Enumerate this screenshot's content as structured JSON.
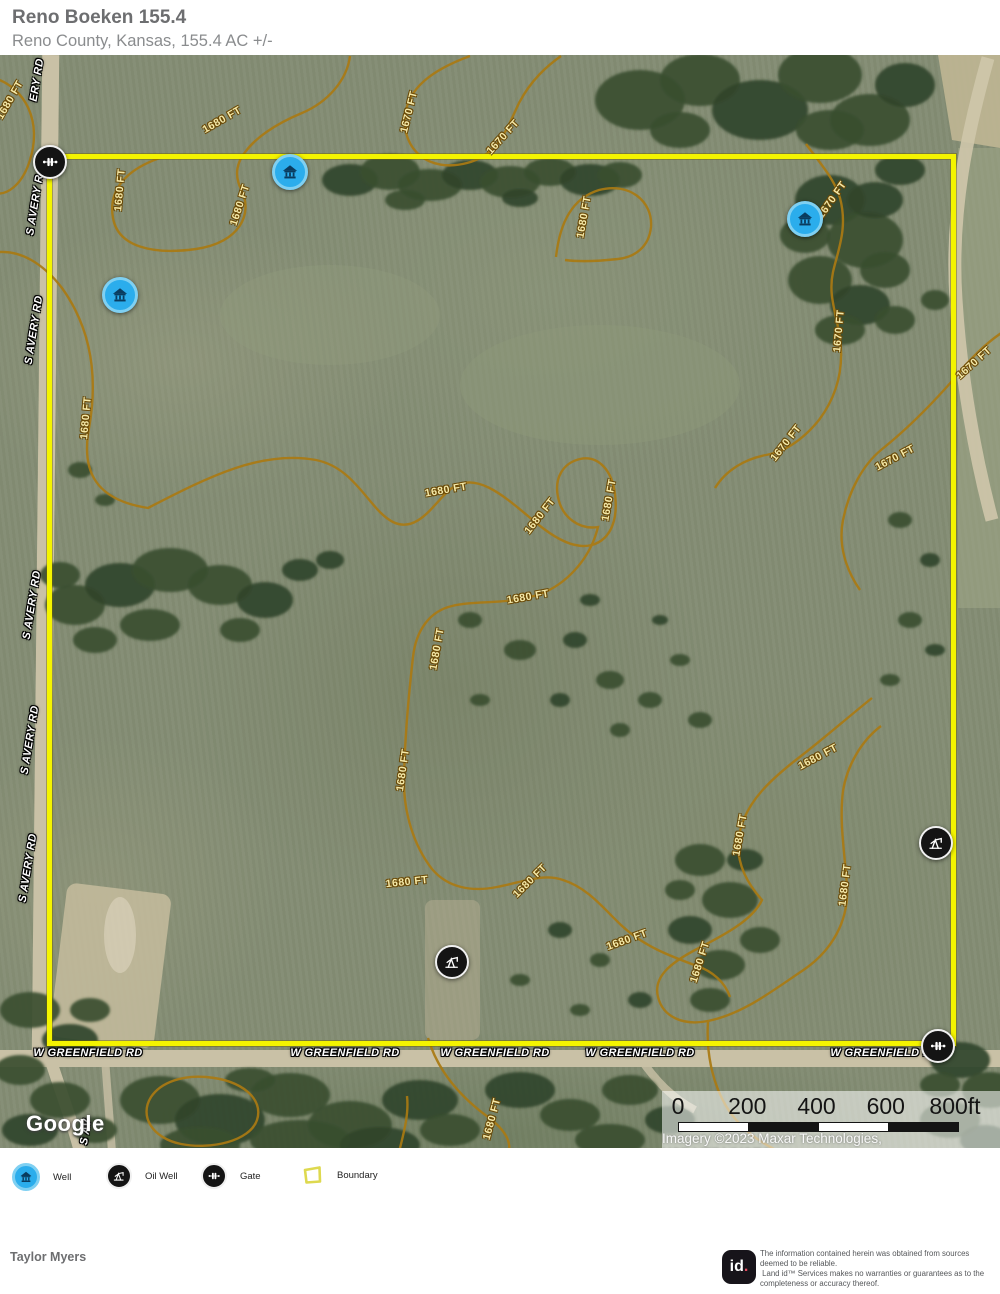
{
  "header": {
    "title": "Reno Boeken 155.4",
    "subtitle": "Reno County, Kansas, 155.4 AC +/-"
  },
  "map": {
    "google_logo": "Google",
    "attribution": "Imagery ©2023 Maxar Technologies, USDA/FPAC/GEO",
    "scale_bar": {
      "ticks": [
        "0",
        "200",
        "400",
        "600",
        "800ft"
      ]
    },
    "road_labels": [
      {
        "text": "W GREENFIELD RD",
        "x": 88,
        "y": 998,
        "r": 0
      },
      {
        "text": "W GREENFIELD RD",
        "x": 345,
        "y": 998,
        "r": 0
      },
      {
        "text": "W GREENFIELD RD",
        "x": 495,
        "y": 998,
        "r": 0
      },
      {
        "text": "W GREENFIELD RD",
        "x": 640,
        "y": 998,
        "r": 0
      },
      {
        "text": "W GREENFIELD RD",
        "x": 885,
        "y": 998,
        "r": 0
      },
      {
        "text": "ERY RD",
        "x": 37,
        "y": 25,
        "r": -81
      },
      {
        "text": "S AVERY R",
        "x": 35,
        "y": 150,
        "r": -81
      },
      {
        "text": "S AVERY RD",
        "x": 34,
        "y": 275,
        "r": -81
      },
      {
        "text": "S AVERY RD",
        "x": 32,
        "y": 550,
        "r": -81
      },
      {
        "text": "S AVERY RD",
        "x": 30,
        "y": 685,
        "r": -81
      },
      {
        "text": "S AVERY RD",
        "x": 28,
        "y": 813,
        "r": -81
      },
      {
        "text": "S AV",
        "x": 86,
        "y": 1077,
        "r": -81
      }
    ],
    "contour_labels": [
      {
        "text": "1680 FT",
        "x": 10,
        "y": 45,
        "r": -60
      },
      {
        "text": "1680 FT",
        "x": 120,
        "y": 135,
        "r": -85
      },
      {
        "text": "1680 FT",
        "x": 222,
        "y": 65,
        "r": -30
      },
      {
        "text": "1680 FT",
        "x": 240,
        "y": 150,
        "r": -72
      },
      {
        "text": "1670 FT",
        "x": 409,
        "y": 57,
        "r": -76
      },
      {
        "text": "1670 FT",
        "x": 503,
        "y": 82,
        "r": -48
      },
      {
        "text": "1680 FT",
        "x": 584,
        "y": 162,
        "r": -80
      },
      {
        "text": "1670 FT",
        "x": 832,
        "y": 145,
        "r": -55
      },
      {
        "text": "1670 FT",
        "x": 839,
        "y": 276,
        "r": -85
      },
      {
        "text": "1670 FT",
        "x": 974,
        "y": 308,
        "r": -42
      },
      {
        "text": "1670 FT",
        "x": 786,
        "y": 388,
        "r": -52
      },
      {
        "text": "1670 FT",
        "x": 895,
        "y": 403,
        "r": -28
      },
      {
        "text": "1680 FT",
        "x": 86,
        "y": 363,
        "r": -85
      },
      {
        "text": "1680 FT",
        "x": 446,
        "y": 435,
        "r": -10
      },
      {
        "text": "1680 FT",
        "x": 540,
        "y": 461,
        "r": -52
      },
      {
        "text": "1680 FT",
        "x": 609,
        "y": 445,
        "r": -80
      },
      {
        "text": "1680 FT",
        "x": 528,
        "y": 542,
        "r": -10
      },
      {
        "text": "1680 FT",
        "x": 437,
        "y": 594,
        "r": -80
      },
      {
        "text": "1680 FT",
        "x": 403,
        "y": 715,
        "r": -82
      },
      {
        "text": "1680 FT",
        "x": 818,
        "y": 702,
        "r": -28
      },
      {
        "text": "1680 FT",
        "x": 740,
        "y": 780,
        "r": -80
      },
      {
        "text": "1680 FT",
        "x": 845,
        "y": 830,
        "r": -83
      },
      {
        "text": "1680 FT",
        "x": 407,
        "y": 827,
        "r": -6
      },
      {
        "text": "1680 FT",
        "x": 530,
        "y": 826,
        "r": -45
      },
      {
        "text": "1680 FT",
        "x": 627,
        "y": 885,
        "r": -20
      },
      {
        "text": "1680 FT",
        "x": 700,
        "y": 907,
        "r": -72
      },
      {
        "text": "1680 FT",
        "x": 492,
        "y": 1064,
        "r": -75
      }
    ],
    "markers": {
      "wells": [
        {
          "x": 290,
          "y": 117
        },
        {
          "x": 120,
          "y": 240
        },
        {
          "x": 805,
          "y": 164
        }
      ],
      "oil_wells": [
        {
          "x": 452,
          "y": 907
        },
        {
          "x": 936,
          "y": 788
        }
      ],
      "gates": [
        {
          "x": 50,
          "y": 107
        },
        {
          "x": 938,
          "y": 991
        }
      ]
    },
    "colors": {
      "boundary": "#f4f400",
      "contour_line": "#aa7a12",
      "contour_text": "#f5e9a8",
      "well_blue": "#2badec",
      "marker_black": "#141414"
    }
  },
  "legend": {
    "items": [
      {
        "type": "well",
        "label": "Well"
      },
      {
        "type": "oil-well",
        "label": "Oil Well"
      },
      {
        "type": "gate",
        "label": "Gate"
      },
      {
        "type": "boundary",
        "label": "Boundary"
      }
    ]
  },
  "footer": {
    "prepared_by": "Taylor Myers",
    "logo_text": "id",
    "logo_dot": ".",
    "disclaimer_lines": [
      "The information contained herein was obtained from sources",
      "deemed to be reliable.",
      " Land id™ Services makes no warranties or guarantees as to the",
      "completeness or accuracy thereof."
    ]
  }
}
